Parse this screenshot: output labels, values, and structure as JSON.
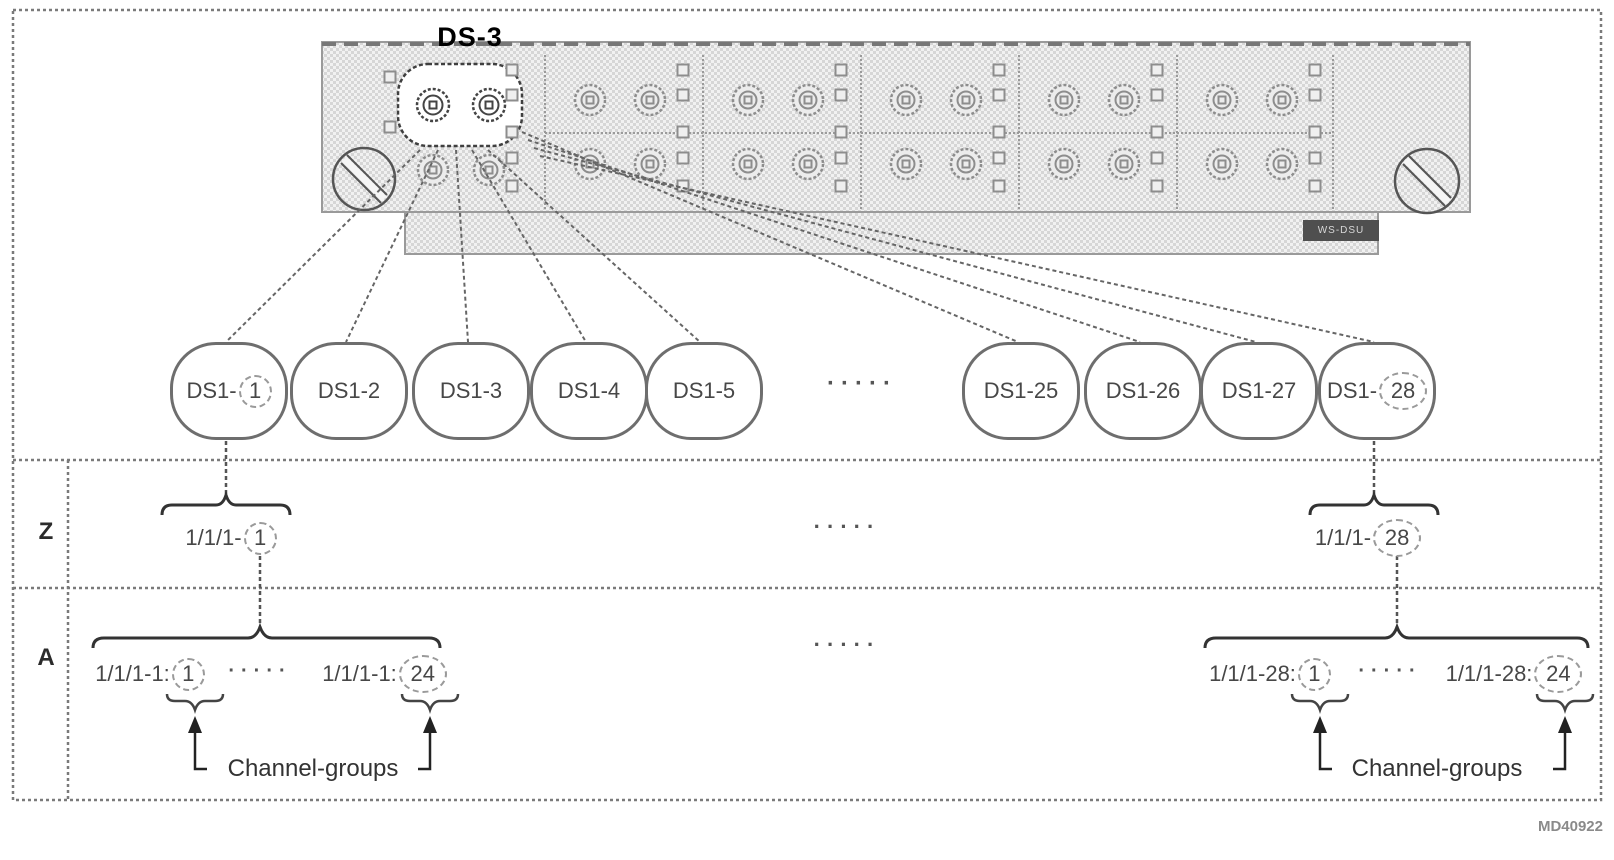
{
  "labels": {
    "ds3_port": "DS-3",
    "card_model": "WS-DSU",
    "figure_id": "MD40922",
    "ellipsis": "·····"
  },
  "ds1_channels": [
    {
      "prefix": "DS1-",
      "circled": "1"
    },
    {
      "prefix": "DS1-2",
      "circled": ""
    },
    {
      "prefix": "DS1-3",
      "circled": ""
    },
    {
      "prefix": "DS1-4",
      "circled": ""
    },
    {
      "prefix": "DS1-5",
      "circled": ""
    },
    {
      "prefix": "DS1-25",
      "circled": ""
    },
    {
      "prefix": "DS1-26",
      "circled": ""
    },
    {
      "prefix": "DS1-27",
      "circled": ""
    },
    {
      "prefix": "DS1-",
      "circled": "28"
    }
  ],
  "z_row": {
    "label": "Z",
    "left": {
      "prefix": "1/1/1-",
      "circled": "1"
    },
    "right": {
      "prefix": "1/1/1-",
      "circled": "28"
    }
  },
  "a_row": {
    "label": "A",
    "left_group": {
      "first": {
        "prefix": "1/1/1-1:",
        "circled": "1"
      },
      "last": {
        "prefix": "1/1/1-1:",
        "circled": "24"
      },
      "caption": "Channel-groups"
    },
    "right_group": {
      "first": {
        "prefix": "1/1/1-28:",
        "circled": "1"
      },
      "last": {
        "prefix": "1/1/1-28:",
        "circled": "24"
      },
      "caption": "Channel-groups"
    }
  },
  "colors": {
    "line": "#6e6e6e",
    "structure_line": "#7a7a7a",
    "text": "#474747",
    "card_fill": "#d6d6d6",
    "brace": "#333333"
  }
}
